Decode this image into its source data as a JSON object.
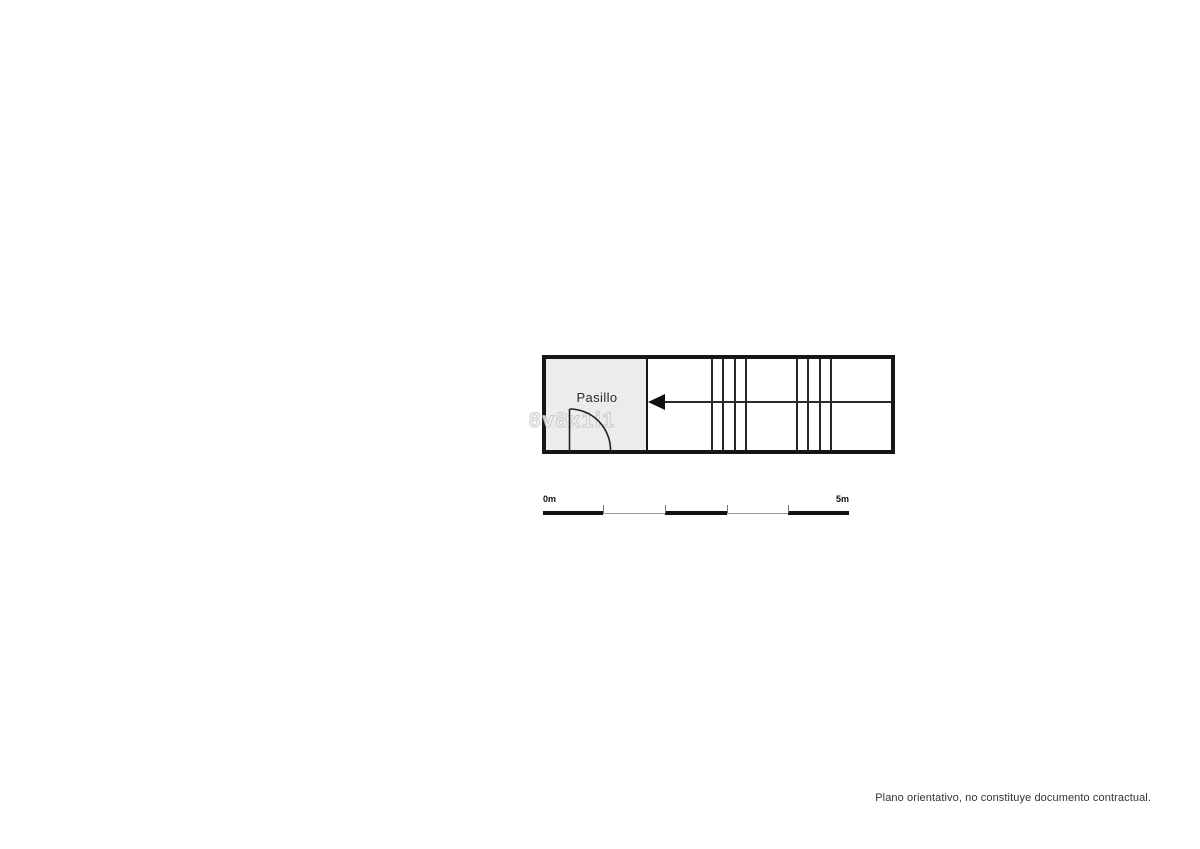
{
  "floorplan": {
    "room_label": "Pasillo",
    "watermark_text": "8v8x1i1",
    "colors": {
      "wall": "#161616",
      "interior_line": "#2b2b2b",
      "room_fill": "#ececec",
      "arrow": "#111111",
      "page_background": "#ffffff"
    }
  },
  "scale_bar": {
    "start_label": "0m",
    "end_label": "5m"
  },
  "footer": {
    "disclaimer": "Plano orientativo, no constituye documento contractual."
  }
}
